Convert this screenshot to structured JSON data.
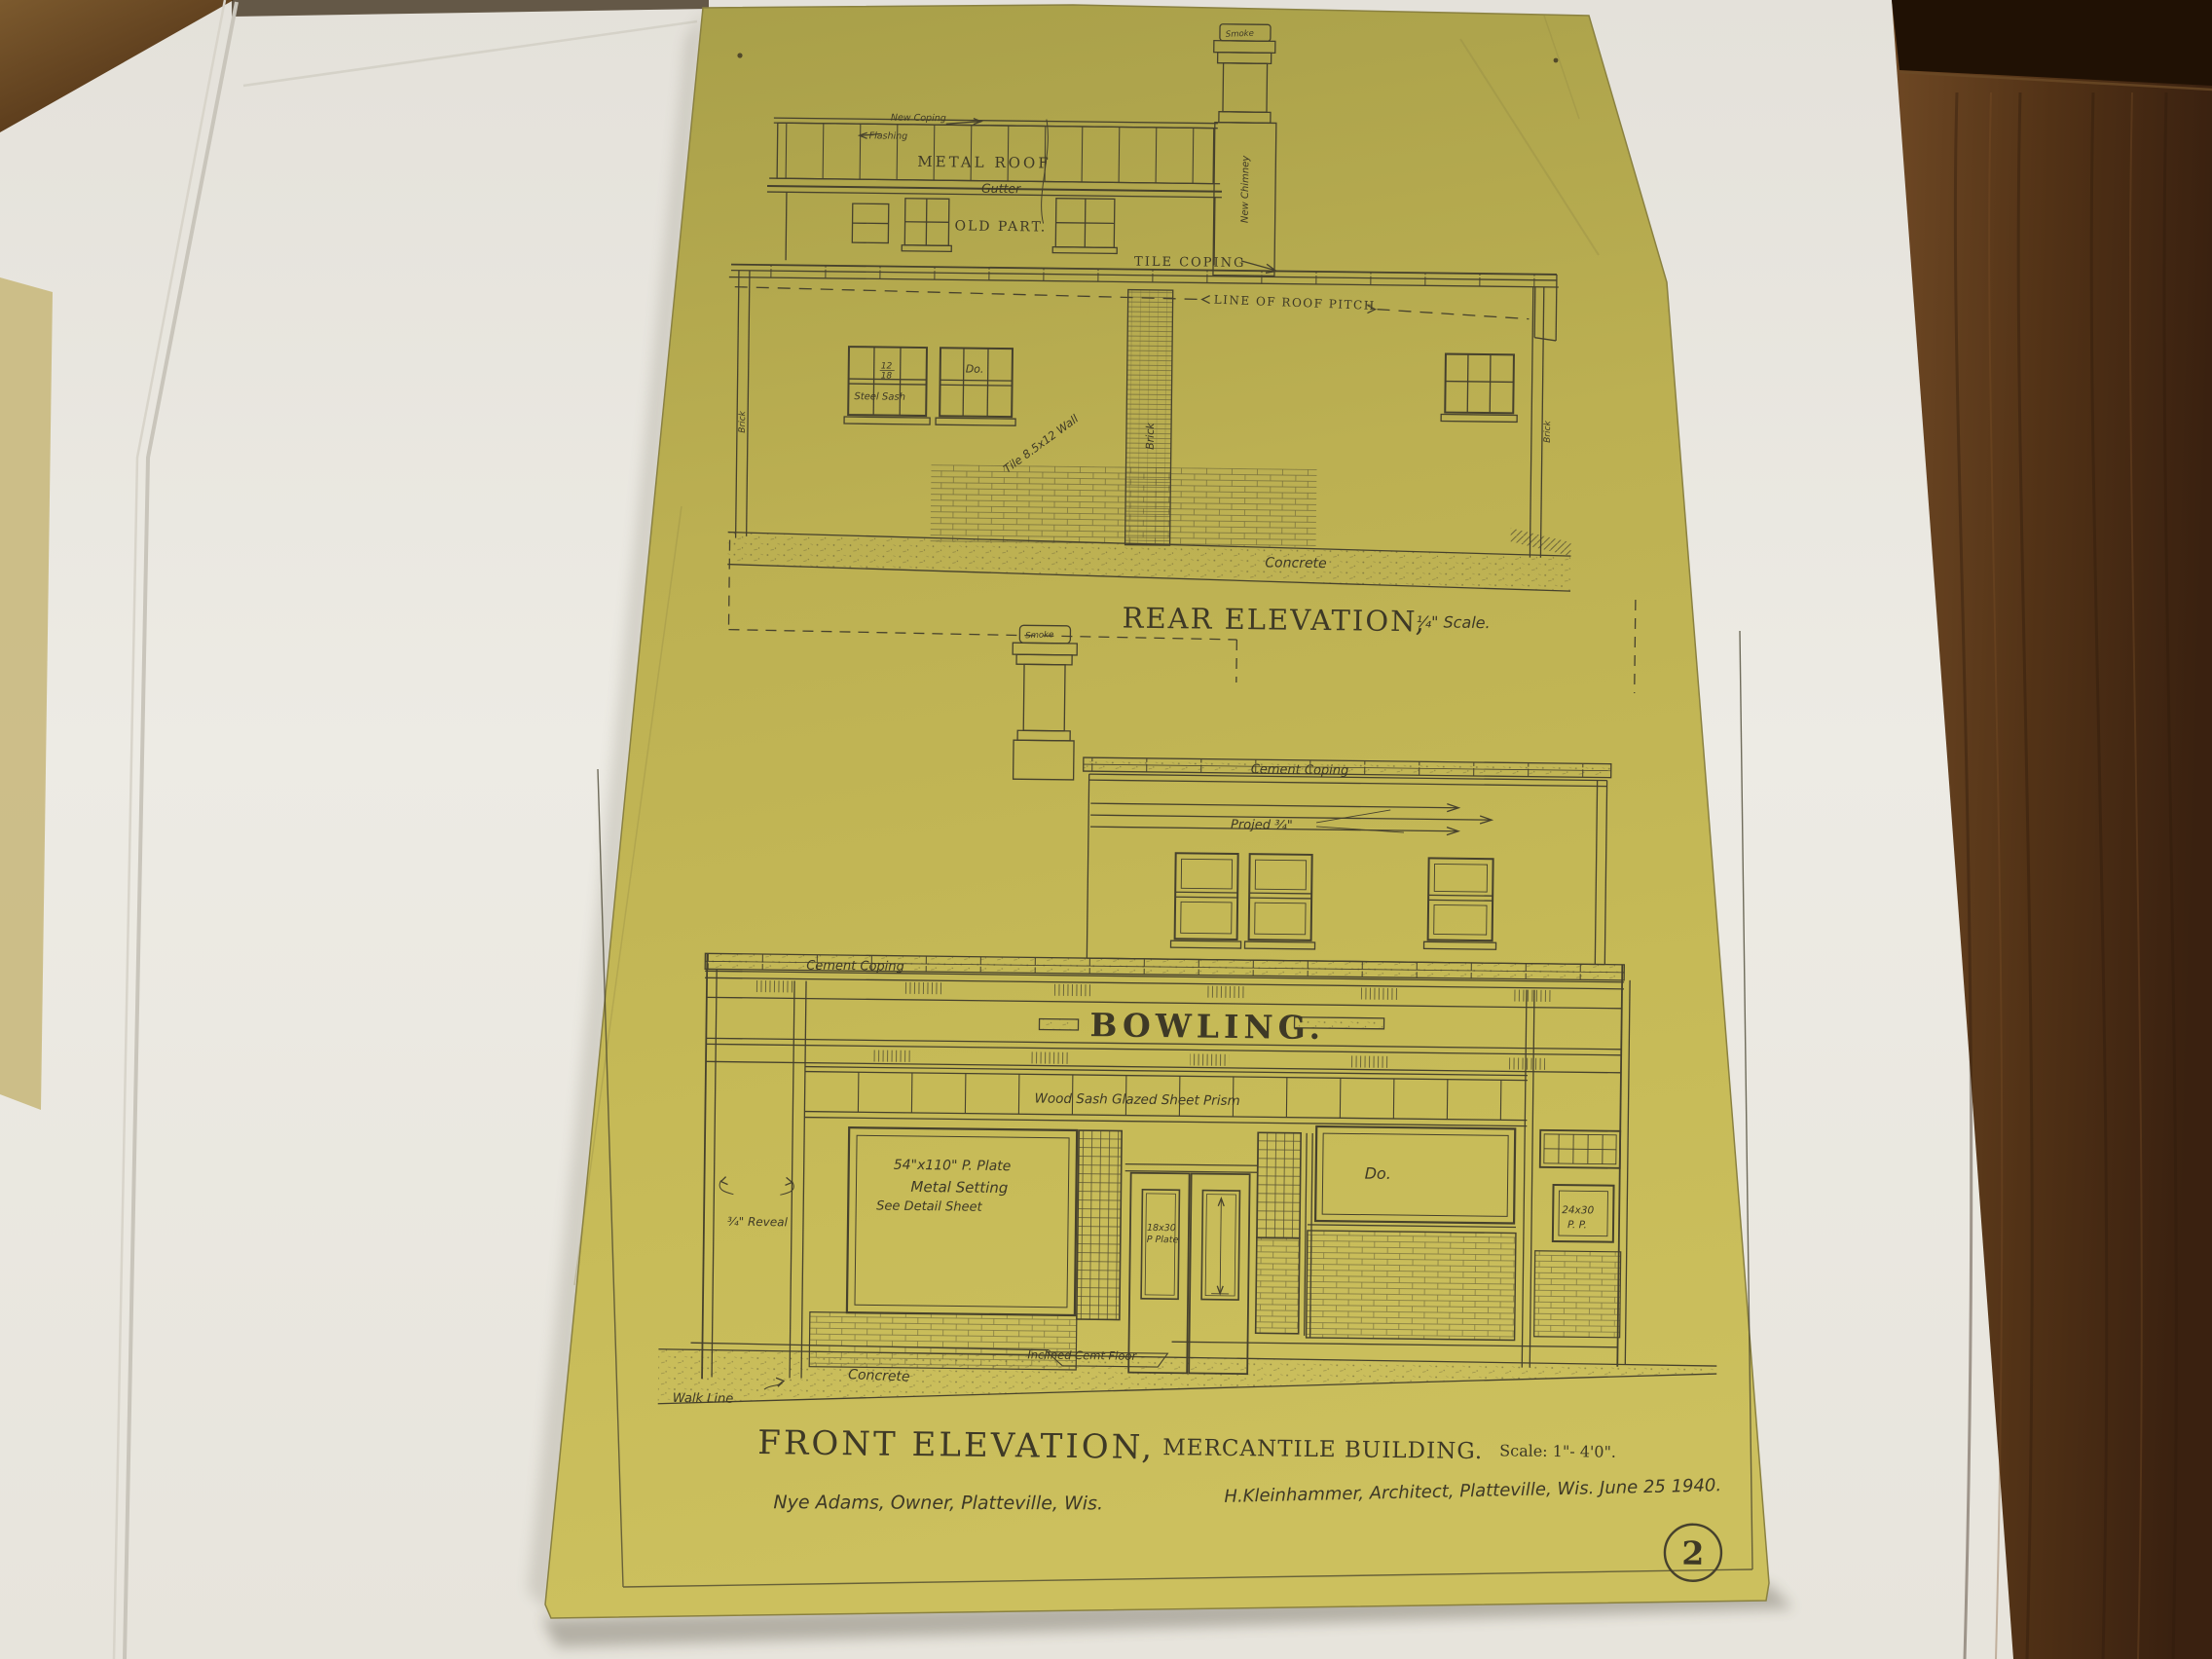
{
  "colors": {
    "sheet_paper": "#c1b454",
    "ink": "#46412d",
    "desk_wood": "#4e2f15",
    "backing_paper": "#eae7e0"
  },
  "sheet": {
    "number": "2"
  },
  "rear": {
    "title": "REAR ELEVATION,",
    "scale_note": "¼\" Scale.",
    "labels": {
      "chimney_cap": "Smoke",
      "new_coping": "New Coping",
      "flashing": "Flashing",
      "metal_roof": "METAL ROOF",
      "gutter": "Gutter",
      "old_part": "OLD PART.",
      "new_chimney": "New Chimney",
      "tile_coping": "TILE COPING",
      "roof_pitch": "LINE OF ROOF PITCH",
      "sash_num": "12",
      "sash_den": "18",
      "steel_sash": "Steel Sash",
      "ditto": "Do.",
      "tile_wall": "Tile 8.5x12 Wall",
      "brick_left": "Brick",
      "brick_pier": "Brick",
      "brick_right": "Brick",
      "concrete": "Concrete"
    }
  },
  "front": {
    "title": "FRONT ELEVATION,",
    "subtitle": "MERCANTILE BUILDING.",
    "scale_note": "Scale: 1\"- 4'0\".",
    "labels": {
      "chimney_cap": "Smoke",
      "cement_coping_top": "Cement Coping",
      "project": "Projed ¾\"",
      "cement_coping_lower": "Cement Coping",
      "sign": "BOWLING.",
      "transom": "Wood Sash Glazed Sheet Prism",
      "plate_size": "54\"x110\" P. Plate",
      "plate_setting": "Metal Setting",
      "see_detail": "See Detail Sheet",
      "door_glass_size": "18x30",
      "door_glass_type": "P Plate",
      "ditto": "Do.",
      "pp_size": "24x30",
      "pp_type": "P. P.",
      "reveal": "¾\" Reveal",
      "inclined_floor": "Inclined Cemt Floor",
      "concrete": "Concrete",
      "walk_line": "Walk Line"
    }
  },
  "footer": {
    "owner": "Nye Adams, Owner, Platteville, Wis.",
    "architect": "H.Kleinhammer, Architect, Platteville, Wis. June 25 1940."
  }
}
